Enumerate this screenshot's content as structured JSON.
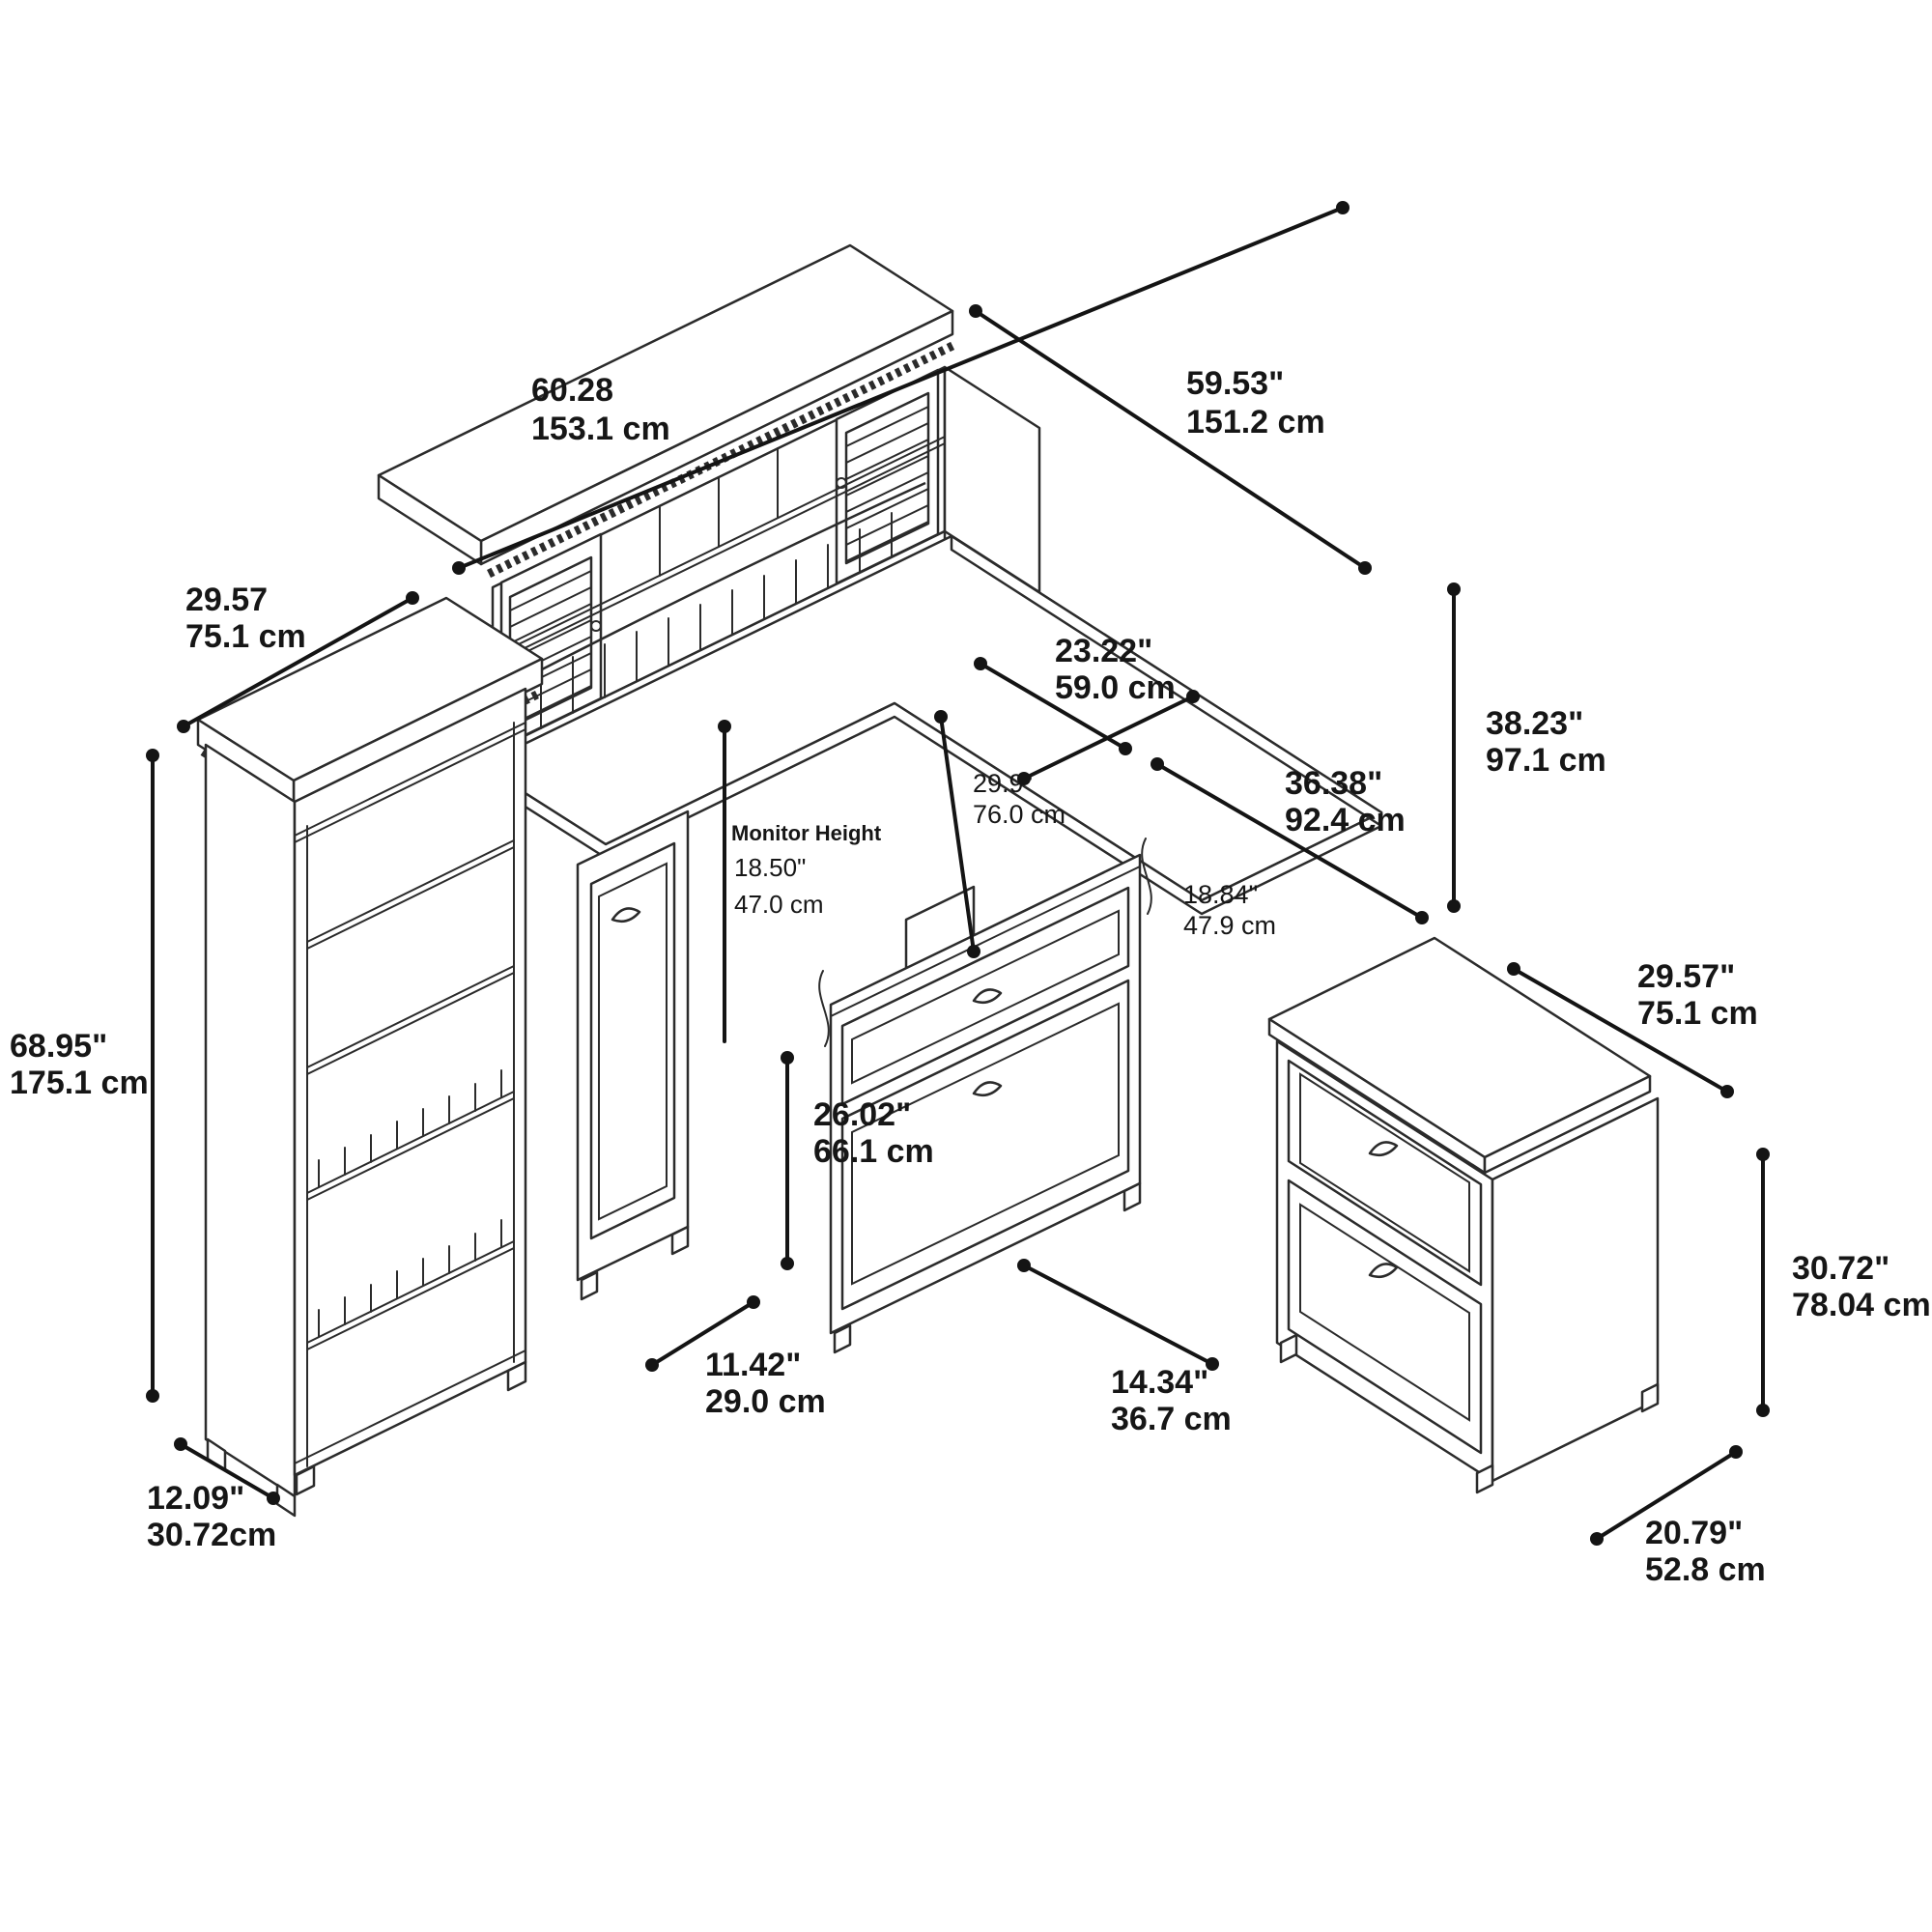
{
  "diagram": {
    "type": "furniture-dimension-diagram",
    "subject": "L-shaped desk with hutch, 5-shelf bookcase and 2-drawer lateral file cabinet (isometric line drawing)"
  },
  "dims": {
    "hutch_width": {
      "in": "60.28",
      "cm": "153.1 cm"
    },
    "return_length": {
      "in": "59.53\"",
      "cm": "151.2 cm"
    },
    "hutch_depth": {
      "in": "29.57",
      "cm": "75.1 cm"
    },
    "bookcase_height": {
      "in": "68.95\"",
      "cm": "175.1 cm"
    },
    "bookcase_depth": {
      "in": "12.09\"",
      "cm": "30.72cm"
    },
    "hutch_height": {
      "in": "23.22\"",
      "cm": "59.0 cm"
    },
    "desk_depth": {
      "in": "29.9\"",
      "cm": "76.0 cm"
    },
    "desk_side": {
      "in": "36.38\"",
      "cm": "92.4 cm"
    },
    "overall_height": {
      "in": "38.23\"",
      "cm": "97.1 cm"
    },
    "monitor": {
      "label": "Monitor Height",
      "in": "18.50\"",
      "cm": "47.0 cm"
    },
    "return_depth": {
      "in": "18.84\"",
      "cm": "47.9 cm"
    },
    "file_width": {
      "in": "29.57\"",
      "cm": "75.1 cm"
    },
    "desk_height": {
      "in": "26.02\"",
      "cm": "66.1 cm"
    },
    "pedestal_width": {
      "in": "11.42\"",
      "cm": "29.0 cm"
    },
    "drawer_ped_width": {
      "in": "14.34\"",
      "cm": "36.7 cm"
    },
    "file_height": {
      "in": "30.72\"",
      "cm": "78.04 cm"
    },
    "file_depth": {
      "in": "20.79\"",
      "cm": "52.8 cm"
    }
  }
}
